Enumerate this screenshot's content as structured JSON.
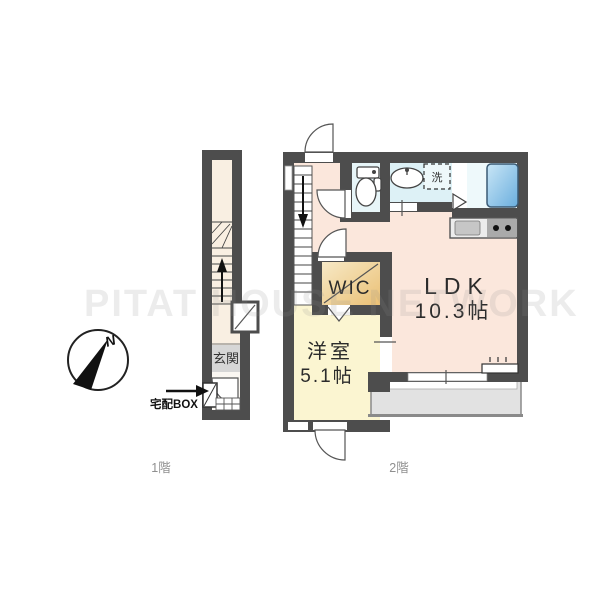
{
  "watermark": "PITAT HOUSE NETWORK",
  "compass": {
    "north": "N"
  },
  "floor1": {
    "caption": "1階",
    "entrance_label": "玄関",
    "delivery_box_label": "宅配BOX"
  },
  "floor2": {
    "caption": "2階",
    "ldk_name": "LDK",
    "ldk_size": "10.3帖",
    "bedroom_name": "洋室",
    "bedroom_size": "5.1帖",
    "wic_label": "WIC",
    "laundry_label": "洗"
  },
  "colors": {
    "wall": "#4d4d4d",
    "ldk_floor": "#fbe7dc",
    "bedroom_floor": "#fbf5d1",
    "wic_floor": "#efcf9a",
    "toilet_floor": "#e7f5f8",
    "washroom_floor": "#ddf1f6",
    "bathroom_floor": "#eef9fb",
    "bathtub": "#79b7e3",
    "entrance_floor": "#d6d6d6",
    "hall_floor": "#f9efe2",
    "balcony_floor": "#e2e2e2"
  }
}
